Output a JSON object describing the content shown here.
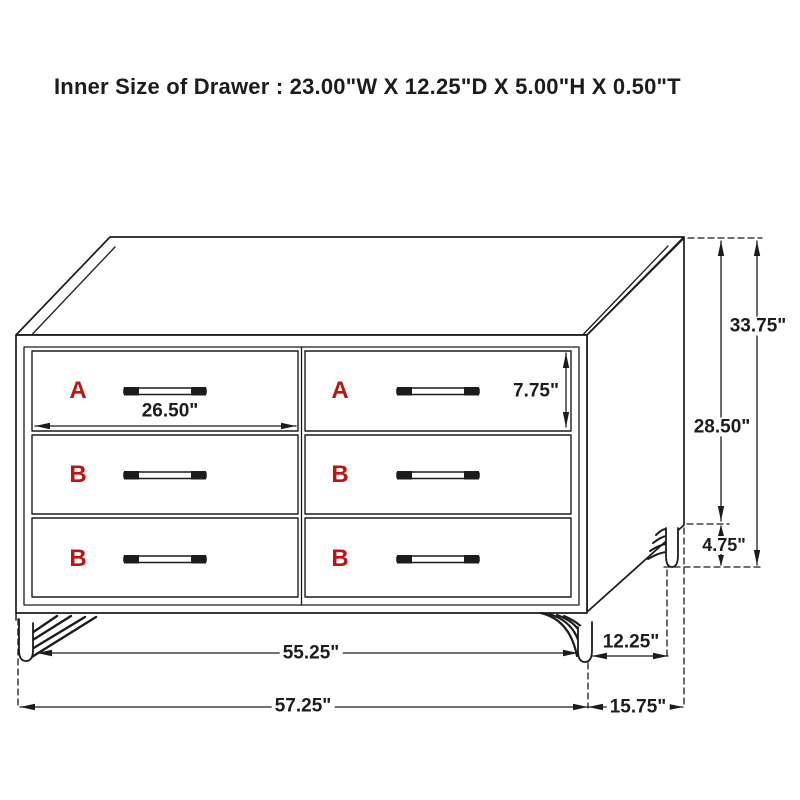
{
  "title": "Inner Size of Drawer : 23.00\"W X 12.25\"D X 5.00\"H X 0.50\"T",
  "colors": {
    "line": "#1c1c1c",
    "drawer_letter_red": "#c11212",
    "background": "#ffffff"
  },
  "drawer_labels": {
    "top_left": "A",
    "top_right": "A",
    "middle_left": "B",
    "middle_right": "B",
    "bottom_left": "B",
    "bottom_right": "B"
  },
  "dimensions": {
    "left_drawer_width": "26.50\"",
    "drawer_front_height": "7.75\"",
    "overall_height": "33.75\"",
    "case_height": "28.50\"",
    "leg_height": "4.75\"",
    "leg_span_width": "55.25\"",
    "leg_span_depth": "12.25\"",
    "overall_width": "57.25\"",
    "overall_depth": "15.75\""
  }
}
